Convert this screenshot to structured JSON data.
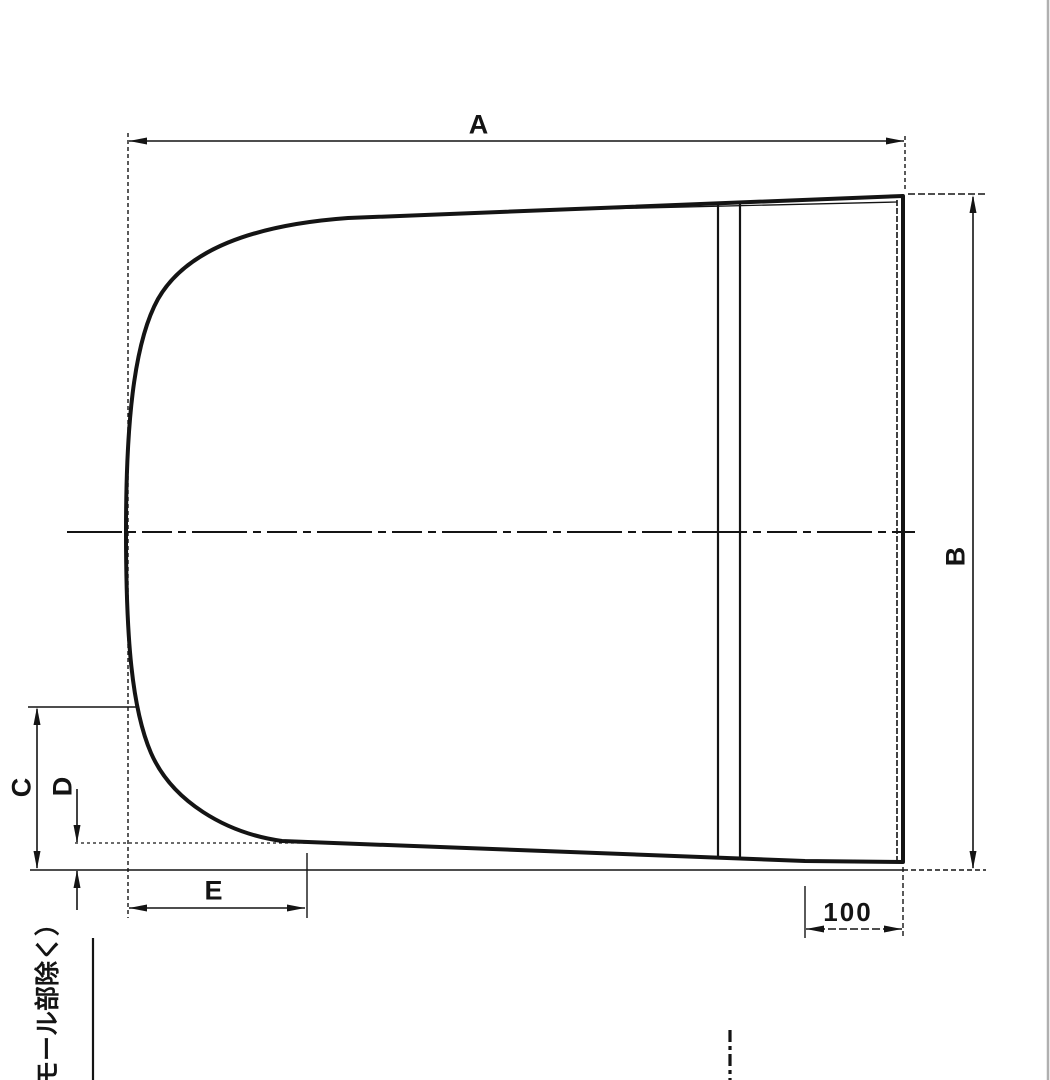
{
  "canvas": {
    "background": "#ffffff",
    "ink_color": "#141414",
    "scan_edge_color": "#b0b0b0"
  },
  "dimension_labels": {
    "a": "A",
    "b": "B",
    "c": "C",
    "d": "D",
    "e": "E",
    "flat_width": "100"
  },
  "annotation": {
    "vertical_note": "モール部除く）"
  }
}
